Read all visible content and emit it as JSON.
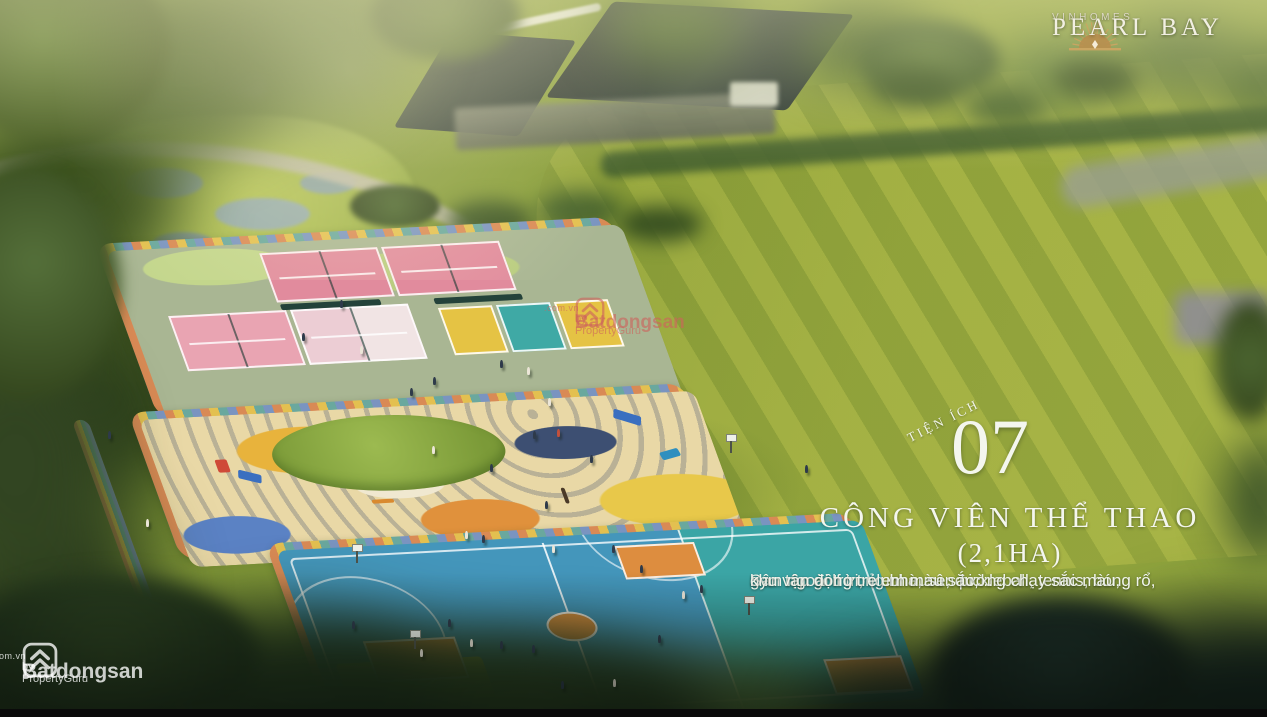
{
  "brand": {
    "name": "VINHOMES",
    "project": "PEARL BAY",
    "logo_icon": "sun-rays-icon",
    "gold": "#c9a566",
    "text_color": "#f2efe2"
  },
  "feature": {
    "label": "TIỆN ÍCH",
    "number": "07",
    "title": "CÔNG VIÊN THỂ THAO",
    "area": "(2,1HA)",
    "description_lines": [
      "Sân tập golf trong nhà, sân pickleball, tennis, bóng rổ,",
      "gym ngoài trời, clubhouse, đường chạy sắc màu,",
      "khu vận động trẻ em màu sắc,..."
    ]
  },
  "watermarks": {
    "center": {
      "brand": "Batdongsan",
      "suffix": ".com.vn",
      "byline": "by PropertyGuru",
      "icon": "batdongsan-logo-icon",
      "color": "#cd625c"
    },
    "bottom_left": {
      "brand": "Batdongsan",
      "suffix": ".com.vn",
      "byline": "by PropertyGuru",
      "icon": "batdongsan-logo-icon",
      "color": "#ffffff"
    }
  },
  "scene_palette": {
    "lawn_green": "#9cab3f",
    "court_surround_sage": "#a9b693",
    "tennis_pink": "#e18b9d",
    "pickleball_yellow": "#e5c344",
    "pickleball_teal": "#3fa9a5",
    "basketball_blue": "#4496bb",
    "basketball_teal": "#3ba5a5",
    "key_orange": "#dd8d3f",
    "playground_cream": "#e9d8a6",
    "playground_blue": "#5b82c4",
    "track_orange": "#d98a55",
    "track_yellow": "#e3c050",
    "track_teal": "#6aa89e",
    "track_blue": "#7a94c0",
    "foliage_dark": "#2b3f1f",
    "roof_charcoal": "#2a3631"
  }
}
